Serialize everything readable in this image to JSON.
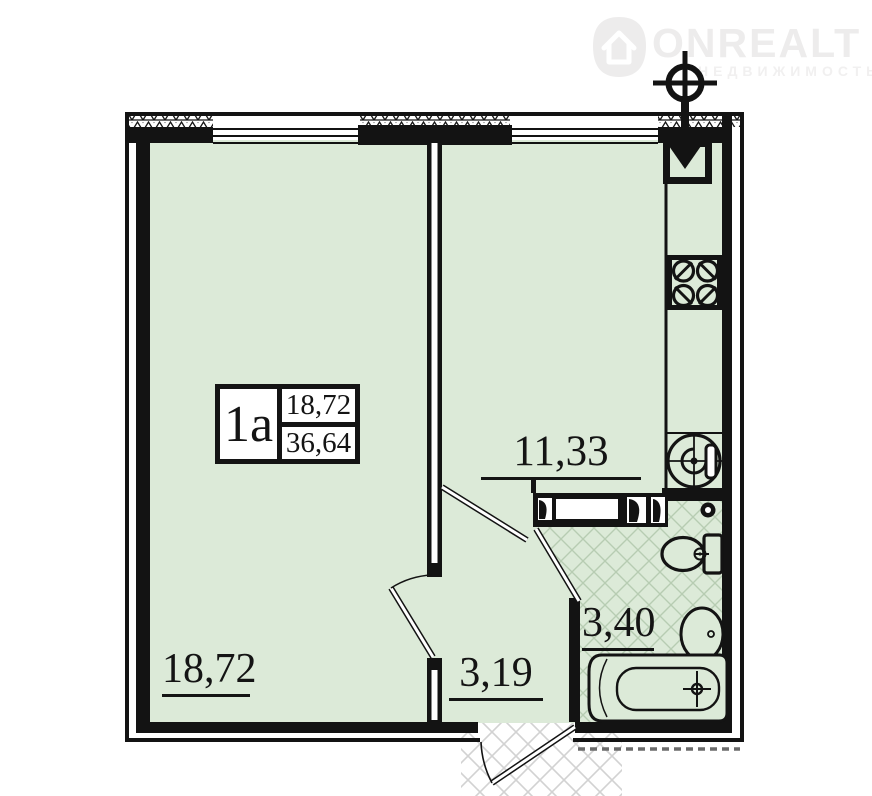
{
  "watermark": {
    "brand": "ONREALT",
    "subtitle": "НЕДВИЖИМОСТЬ"
  },
  "unit_box": {
    "type": "1а",
    "upper": "18,72",
    "lower": "36,64"
  },
  "labels": {
    "living_area": "18,72",
    "hall_area": "3,19",
    "kitchen_area": "11,33",
    "bath_area": "3,40"
  },
  "colors": {
    "floor": "#dcead8",
    "watermark": "#edecec",
    "watermark2": "#f1f0f0"
  }
}
